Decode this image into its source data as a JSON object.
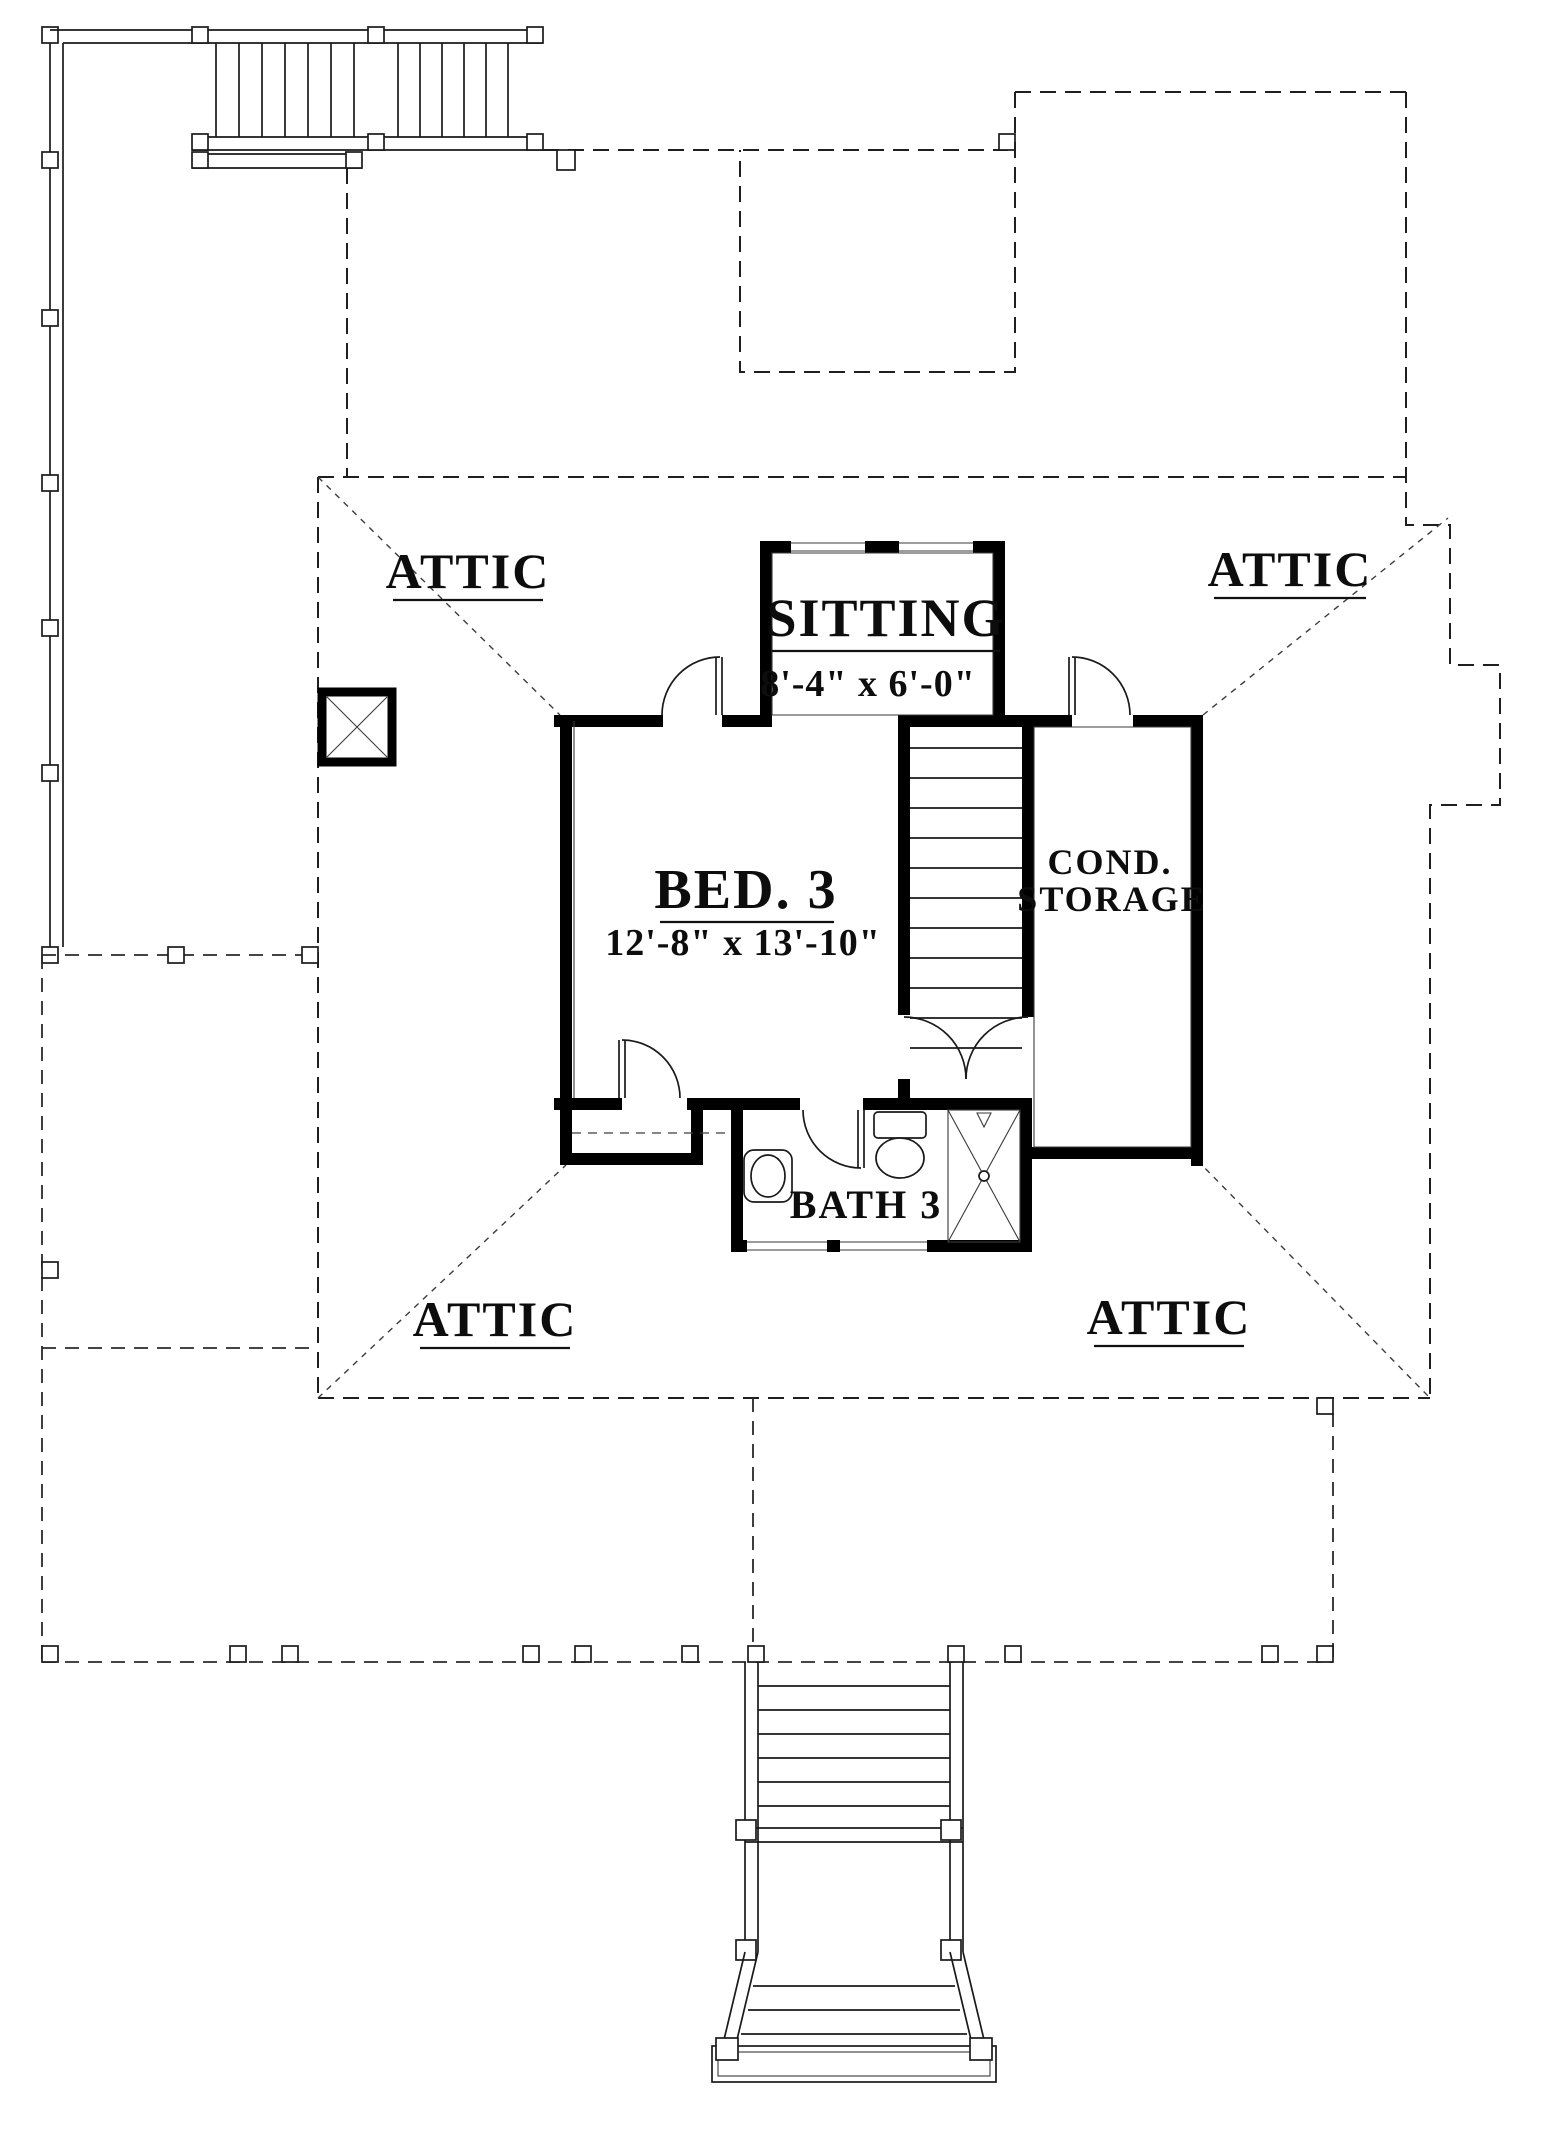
{
  "drawing": {
    "background_color": "#ffffff",
    "line_color": "#000000"
  },
  "rooms": {
    "attic_top_left": {
      "label": "ATTIC"
    },
    "attic_top_right": {
      "label": "ATTIC"
    },
    "attic_bottom_left": {
      "label": "ATTIC"
    },
    "attic_bottom_right": {
      "label": "ATTIC"
    },
    "sitting": {
      "label": "SITTING",
      "dims": "8'-4\" x 6'-0\""
    },
    "bed3": {
      "label": "BED. 3",
      "dims": "12'-8\" x 13'-10\""
    },
    "cond_storage": {
      "label_line1": "COND.",
      "label_line2": "STORAGE"
    },
    "bath3": {
      "label": "BATH 3"
    }
  }
}
